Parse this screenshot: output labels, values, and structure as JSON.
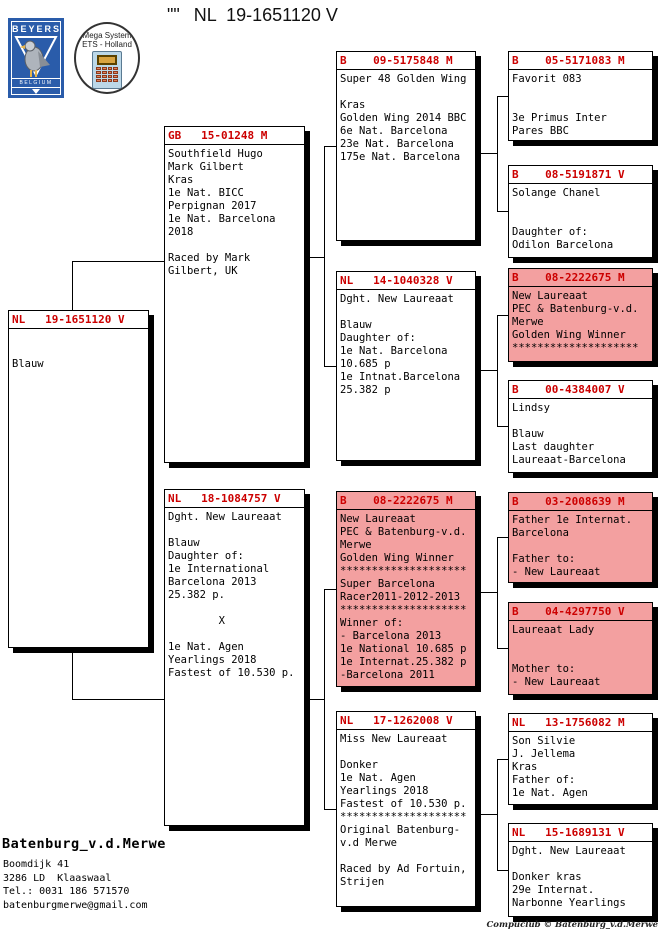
{
  "title": {
    "quote_mark": "\"\"",
    "ring": "NL  19-1651120 V"
  },
  "logos": {
    "beyers": {
      "name": "BEYERS",
      "country": "BELGIUM"
    },
    "mega_system": {
      "line1": "Mega System",
      "line2": "ETS - Holland"
    }
  },
  "colors": {
    "ring_red": "#CC0000",
    "highlight_pink": "#F3A0A0",
    "beyers_blue": "#2A5CAA"
  },
  "boxes": {
    "subject": {
      "header": "NL   19-1651120 V",
      "pink": false,
      "body": [
        "",
        "",
        "Blauw"
      ]
    },
    "father": {
      "header": "GB   15-01248 M",
      "pink": false,
      "body": [
        "Southfield Hugo",
        "Mark Gilbert",
        "Kras",
        "1e Nat. BICC",
        "Perpignan 2017",
        "1e Nat. Barcelona",
        "2018",
        "",
        "Raced by Mark",
        "Gilbert, UK"
      ]
    },
    "mother": {
      "header": "NL   18-1084757 V",
      "pink": false,
      "body": [
        "Dght. New Laureaat",
        "",
        "Blauw",
        "Daughter of:",
        "1e International",
        "Barcelona 2013",
        "25.382 p.",
        "",
        "        X",
        "",
        "1e Nat. Agen",
        "Yearlings 2018",
        "Fastest of 10.530 p."
      ]
    },
    "ff": {
      "header": "B    09-5175848 M",
      "pink": false,
      "body": [
        "Super 48 Golden Wing",
        "",
        "Kras",
        "Golden Wing 2014 BBC",
        "6e Nat. Barcelona",
        "23e Nat. Barcelona",
        "175e Nat. Barcelona"
      ]
    },
    "fm": {
      "header": "NL   14-1040328 V",
      "pink": false,
      "body": [
        "Dght. New Laureaat",
        "",
        "Blauw",
        "Daughter of:",
        "1e Nat. Barcelona",
        "10.685 p",
        "1e Intnat.Barcelona",
        "25.382 p"
      ]
    },
    "mf": {
      "header": "B    08-2222675 M",
      "pink": true,
      "body": [
        "New Laureaat",
        "PEC & Batenburg-v.d.",
        "Merwe",
        "Golden Wing Winner",
        "********************",
        "Super Barcelona",
        "Racer2011-2012-2013",
        "********************",
        "Winner of:",
        "- Barcelona 2013",
        "1e National 10.685 p",
        "1e Internat.25.382 p",
        "-Barcelona 2011"
      ]
    },
    "mm": {
      "header": "NL   17-1262008 V",
      "pink": false,
      "body": [
        "Miss New Laureaat",
        "",
        "Donker",
        "1e Nat. Agen",
        "Yearlings 2018",
        "Fastest of 10.530 p.",
        "********************",
        "Original Batenburg-",
        "v.d Merwe",
        "",
        "Raced by Ad Fortuin,",
        "Strijen"
      ]
    },
    "fff": {
      "header": "B    05-5171083 M",
      "pink": false,
      "body": [
        "Favorit 083",
        "",
        "",
        "3e Primus Inter",
        "Pares BBC"
      ]
    },
    "ffm": {
      "header": "B    08-5191871 V",
      "pink": false,
      "body": [
        "Solange Chanel",
        "",
        "",
        "Daughter of:",
        "Odilon Barcelona"
      ]
    },
    "fmf": {
      "header": "B    08-2222675 M",
      "pink": true,
      "body": [
        "New Laureaat",
        "PEC & Batenburg-v.d.",
        "Merwe",
        "Golden Wing Winner",
        "********************"
      ]
    },
    "fmm": {
      "header": "B    00-4384007 V",
      "pink": false,
      "body": [
        "Lindsy",
        "",
        "Blauw",
        "Last daughter",
        "Laureaat-Barcelona"
      ]
    },
    "mff": {
      "header": "B    03-2008639 M",
      "pink": true,
      "body": [
        "Father 1e Internat.",
        "Barcelona",
        "",
        "Father to:",
        "- New Laureaat"
      ]
    },
    "mfm": {
      "header": "B    04-4297750 V",
      "pink": true,
      "body": [
        "Laureaat Lady",
        "",
        "",
        "Mother to:",
        "- New Laureaat"
      ]
    },
    "mmf": {
      "header": "NL   13-1756082 M",
      "pink": false,
      "body": [
        "Son Silvie",
        "J. Jellema",
        "Kras",
        "Father of:",
        "1e Nat. Agen"
      ]
    },
    "mmm": {
      "header": "NL   15-1689131 V",
      "pink": false,
      "body": [
        "Dght. New Laureaat",
        "",
        "Donker kras",
        "29e Internat.",
        "Narbonne Yearlings"
      ]
    }
  },
  "footer": {
    "owner": "Batenburg_v.d.Merwe",
    "address": [
      "Boomdijk 41",
      "3286 LD  Klaaswaal",
      "Tel.: 0031 186 571570",
      "batenburgmerwe@gmail.com"
    ],
    "credit": "Compuclub © Batenburg_v.d.Merwe"
  }
}
